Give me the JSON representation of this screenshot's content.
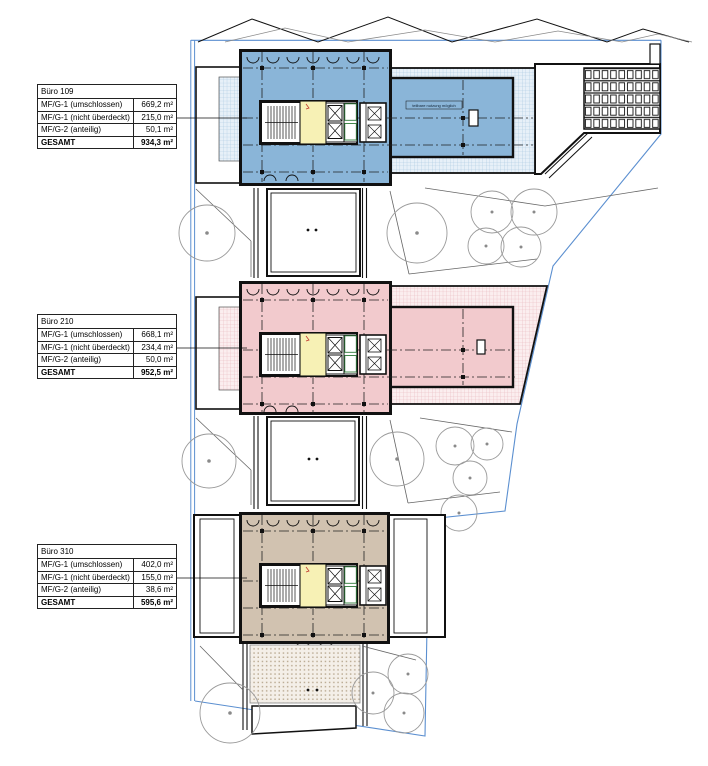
{
  "colors": {
    "accent_blue": "#8ab5d8",
    "accent_blue_light": "#e7f0f8",
    "accent_blue_grid": "#a3c5df",
    "accent_pink": "#f2cacd",
    "accent_pink_light": "#fbeeef",
    "accent_pink_grid": "#e7b3ba",
    "accent_tan": "#d1c2b0",
    "accent_tan_light": "#f4efe8",
    "accent_tan_dot": "#bdae97",
    "accent_yellow": "#f7f1b5",
    "boundary_blue": "#5b8fd0",
    "tree_gray": "#9a9a9a"
  },
  "tables": [
    {
      "title": "Büro 109",
      "rows": [
        {
          "label": "MF/G-1 (umschlossen)",
          "value": "669,2 m²"
        },
        {
          "label": "MF/G-1 (nicht überdeckt)",
          "value": "215,0 m²"
        },
        {
          "label": "MF/G-2 (anteilig)",
          "value": "50,1 m²"
        }
      ],
      "total": {
        "label": "GESAMT",
        "value": "934,3 m²"
      }
    },
    {
      "title": "Büro 210",
      "rows": [
        {
          "label": "MF/G-1 (umschlossen)",
          "value": "668,1 m²"
        },
        {
          "label": "MF/G-1 (nicht überdeckt)",
          "value": "234,4 m²"
        },
        {
          "label": "MF/G-2 (anteilig)",
          "value": "50,0 m²"
        }
      ],
      "total": {
        "label": "GESAMT",
        "value": "952,5 m²"
      }
    },
    {
      "title": "Büro 310",
      "rows": [
        {
          "label": "MF/G-1 (umschlossen)",
          "value": "402,0 m²"
        },
        {
          "label": "MF/G-1 (nicht überdeckt)",
          "value": "155,0 m²"
        },
        {
          "label": "MF/G-2 (anteilig)",
          "value": "38,6 m²"
        }
      ],
      "total": {
        "label": "GESAMT",
        "value": "595,6 m²"
      }
    }
  ],
  "plan": {
    "wing_annotation": "teilbare nutzung möglich"
  }
}
